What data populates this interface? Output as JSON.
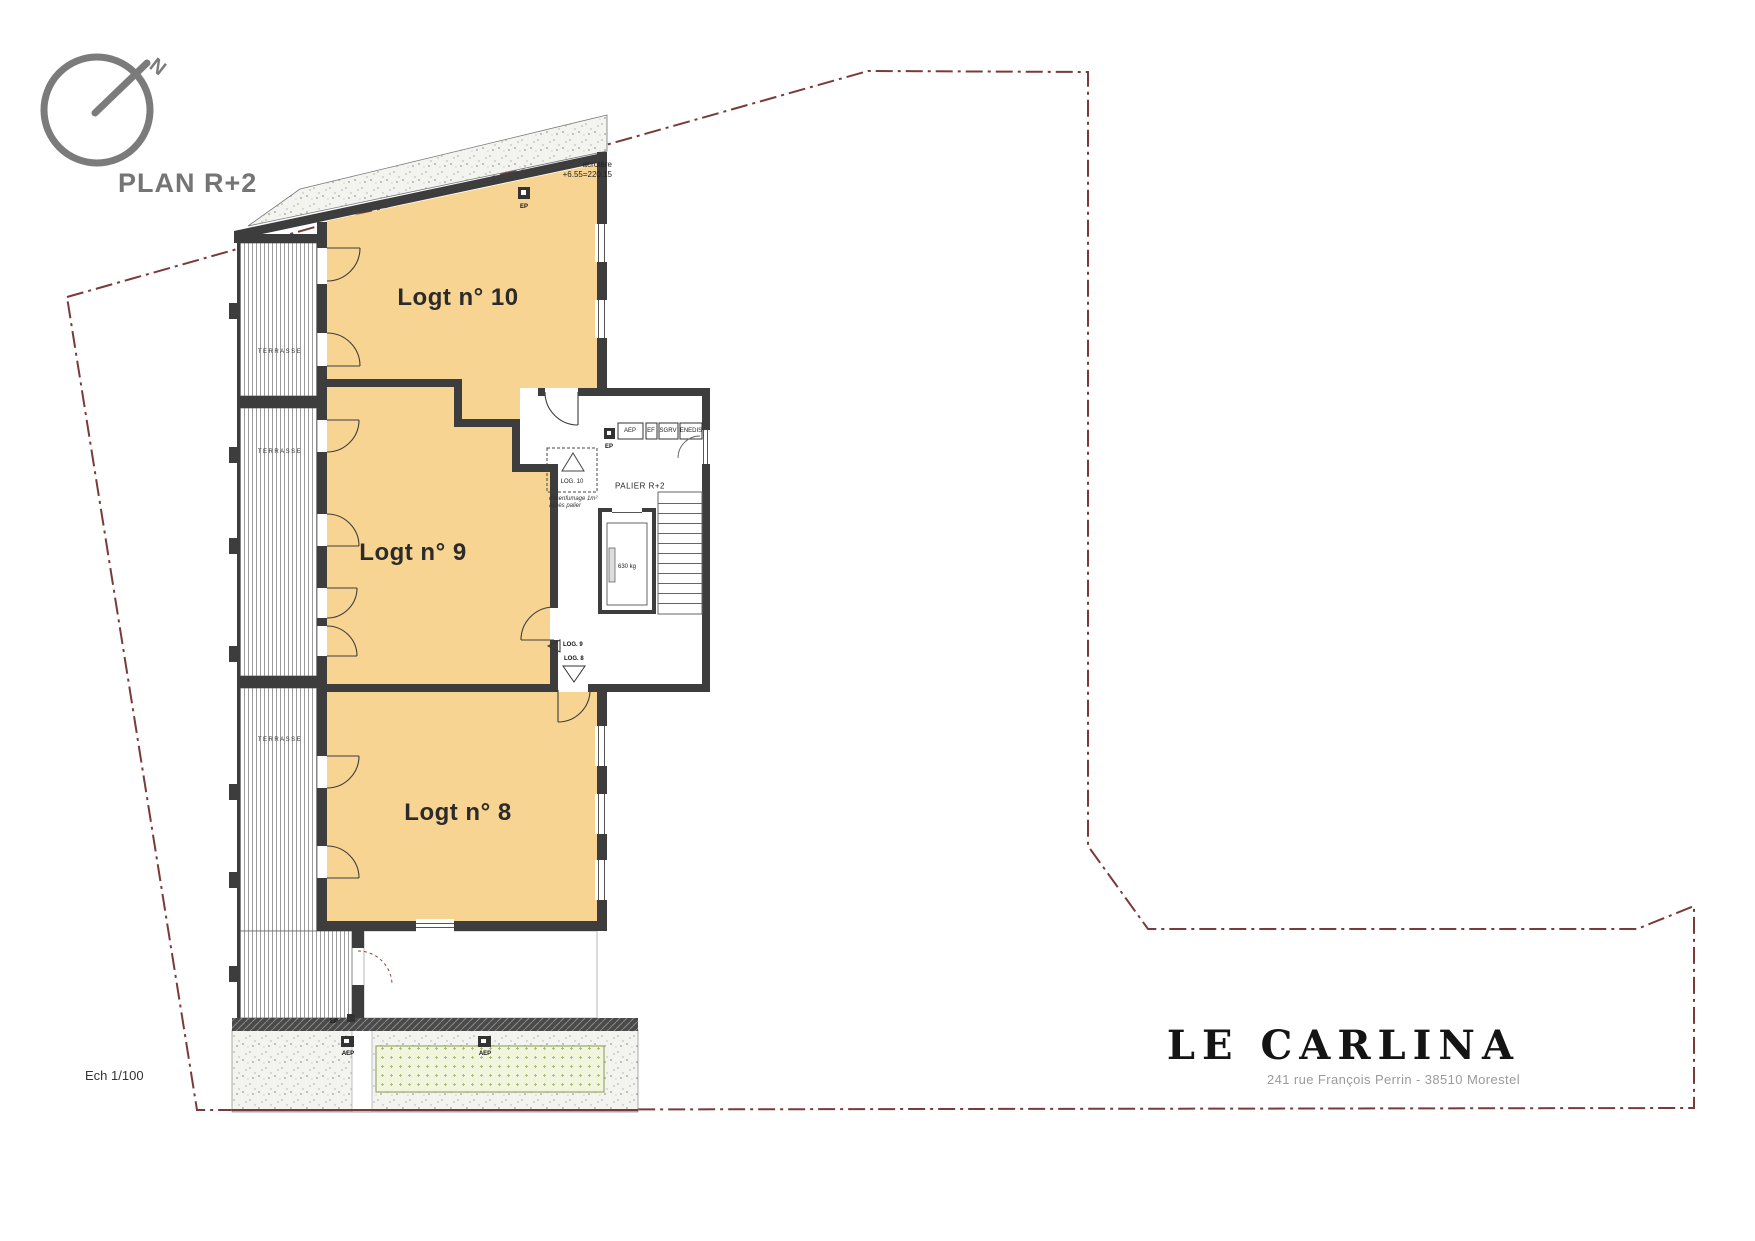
{
  "header": {
    "north": "N",
    "plan_title": "PLAN R+2"
  },
  "apartments": {
    "a10": "Logt n° 10",
    "a9": "Logt n° 9",
    "a8": "Logt n° 8"
  },
  "annotations": {
    "terrasse": "TERRASSE",
    "acrotere": "acrotère",
    "acrotere_level": "+6.55=220.15",
    "ep": "EP",
    "aep": "AEP"
  },
  "core": {
    "palier": "PALIER R+2",
    "vent_label": "LOG. 10",
    "vent_note1": "désenfumage 1m²",
    "vent_note2": "accès palier",
    "entry9": "LOG. 9",
    "entry8": "LOG. 8",
    "lift": "630 kg",
    "meters": [
      "AEP",
      "EF",
      "SGRV",
      "ENEDIS"
    ],
    "ep": "EP"
  },
  "footer": {
    "scale": "Ech 1/100",
    "project": "LE CARLINA",
    "address": "241 rue François Perrin - 38510 Morestel"
  },
  "colors": {
    "apartment_fill": "#F8D492",
    "wall": "#3D3D3D",
    "boundary": "#7A3A3A",
    "title_gray": "#757575"
  }
}
